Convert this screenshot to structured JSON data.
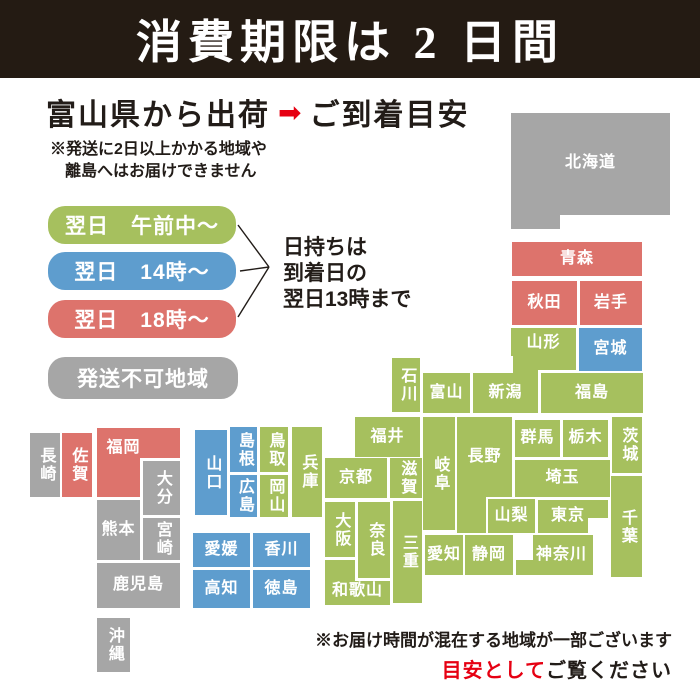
{
  "header": {
    "title": "消費期限は 2 日間"
  },
  "shipping": {
    "from_label": "富山県から出荷",
    "arrow": "➡",
    "to_label": "ご到着目安",
    "note_line1": "※発送に2日以上かかる地域や",
    "note_line2": "離島へはお届けできません"
  },
  "legend": {
    "items": [
      {
        "key": "morning",
        "label": "翌日　午前中～",
        "color": "#a6c05e"
      },
      {
        "key": "t14",
        "label": "翌日　14時～",
        "color": "#5e9dce"
      },
      {
        "key": "t18",
        "label": "翌日　18時～",
        "color": "#dd736c"
      },
      {
        "key": "noship",
        "label": "発送不可地域",
        "color": "#a6a6a6"
      }
    ],
    "keep_note_line1": "日持ちは",
    "keep_note_line2": "到着日の",
    "keep_note_line3": "翌日13時まで"
  },
  "footer": {
    "line1": "※お届け時間が混在する地域が一部ございます",
    "line2_red": "目安として",
    "line2_black": "ご覧ください"
  },
  "colors": {
    "green": "#a6c05e",
    "blue": "#5e9dce",
    "red": "#dd736c",
    "gray": "#a6a6a6",
    "accent": "#e60012",
    "header_bg": "#241b13"
  },
  "map": {
    "prefectures": [
      {
        "name": "北海道",
        "cat": "gray",
        "x": 511,
        "y": 113,
        "w": 159,
        "h": 116,
        "clip": "0,0 159,0 159,102 49,102 49,116 0,116",
        "pb": 16
      },
      {
        "name": "青森",
        "cat": "red",
        "x": 512,
        "y": 242,
        "w": 130,
        "h": 34
      },
      {
        "name": "秋田",
        "cat": "red",
        "x": 512,
        "y": 281,
        "w": 65,
        "h": 44
      },
      {
        "name": "岩手",
        "cat": "red",
        "x": 580,
        "y": 281,
        "w": 62,
        "h": 44
      },
      {
        "name": "山形",
        "cat": "green",
        "x": 511,
        "y": 328,
        "w": 65,
        "h": 42,
        "clip": "0,0 65,0 65,42 27,42 27,28 0,28",
        "pb": 12
      },
      {
        "name": "宮城",
        "cat": "blue",
        "x": 579,
        "y": 328,
        "w": 63,
        "h": 43
      },
      {
        "name": "新潟",
        "cat": "green",
        "x": 473,
        "y": 356,
        "w": 65,
        "h": 57,
        "clip": "0,17 40,17 40,0 65,0 65,57 0,57",
        "pt": 17
      },
      {
        "name": "福島",
        "cat": "green",
        "x": 541,
        "y": 373,
        "w": 102,
        "h": 40
      },
      {
        "name": "石川",
        "cat": "green",
        "x": 392,
        "y": 358,
        "w": 28,
        "h": 54,
        "v": 1
      },
      {
        "name": "富山",
        "cat": "green",
        "x": 423,
        "y": 373,
        "w": 47,
        "h": 40
      },
      {
        "name": "福井",
        "cat": "green",
        "x": 355,
        "y": 417,
        "w": 65,
        "h": 40
      },
      {
        "name": "岐阜",
        "cat": "green",
        "x": 423,
        "y": 417,
        "w": 32,
        "h": 113,
        "v": 1
      },
      {
        "name": "長野",
        "cat": "green",
        "x": 457,
        "y": 417,
        "w": 55,
        "h": 116,
        "clip": "0,0 55,0 55,80 29,80 29,116 0,116",
        "pb": 36
      },
      {
        "name": "群馬",
        "cat": "green",
        "x": 515,
        "y": 420,
        "w": 45,
        "h": 37
      },
      {
        "name": "栃木",
        "cat": "green",
        "x": 563,
        "y": 420,
        "w": 45,
        "h": 37
      },
      {
        "name": "茨城",
        "cat": "green",
        "x": 612,
        "y": 417,
        "w": 30,
        "h": 56,
        "v": 1
      },
      {
        "name": "埼玉",
        "cat": "green",
        "x": 515,
        "y": 460,
        "w": 95,
        "h": 37
      },
      {
        "name": "山梨",
        "cat": "green",
        "x": 488,
        "y": 499,
        "w": 47,
        "h": 34
      },
      {
        "name": "東京",
        "cat": "green",
        "x": 538,
        "y": 500,
        "w": 70,
        "h": 33,
        "clip": "0,0 70,0 70,18 50,18 50,33 0,33",
        "pr": 10
      },
      {
        "name": "千葉",
        "cat": "green",
        "x": 611,
        "y": 476,
        "w": 31,
        "h": 101,
        "v": 1
      },
      {
        "name": "神奈川",
        "cat": "green",
        "x": 516,
        "y": 535,
        "w": 77,
        "h": 40,
        "clip": "17,0 77,0 77,40 0,40 0,25 17,25",
        "pl": 14
      },
      {
        "name": "京都",
        "cat": "green",
        "x": 325,
        "y": 458,
        "w": 62,
        "h": 40
      },
      {
        "name": "滋賀",
        "cat": "green",
        "x": 390,
        "y": 458,
        "w": 32,
        "h": 40,
        "v": 1
      },
      {
        "name": "大阪",
        "cat": "green",
        "x": 325,
        "y": 502,
        "w": 30,
        "h": 55,
        "v": 1
      },
      {
        "name": "奈良",
        "cat": "green",
        "x": 358,
        "y": 502,
        "w": 32,
        "h": 76,
        "v": 1
      },
      {
        "name": "三重",
        "cat": "green",
        "x": 393,
        "y": 501,
        "w": 29,
        "h": 102,
        "v": 1
      },
      {
        "name": "和歌山",
        "cat": "green",
        "x": 325,
        "y": 560,
        "w": 65,
        "h": 45,
        "clip": "0,0 30,0 30,21 65,21 65,45 0,45",
        "pt": 18
      },
      {
        "name": "兵庫",
        "cat": "green",
        "x": 292,
        "y": 427,
        "w": 30,
        "h": 90,
        "v": 1
      },
      {
        "name": "鳥取",
        "cat": "green",
        "x": 260,
        "y": 427,
        "w": 28,
        "h": 45,
        "v": 1
      },
      {
        "name": "岡山",
        "cat": "green",
        "x": 260,
        "y": 475,
        "w": 28,
        "h": 42,
        "v": 1
      },
      {
        "name": "島根",
        "cat": "blue",
        "x": 230,
        "y": 427,
        "w": 27,
        "h": 45,
        "v": 1
      },
      {
        "name": "広島",
        "cat": "blue",
        "x": 230,
        "y": 475,
        "w": 27,
        "h": 42,
        "v": 1
      },
      {
        "name": "山口",
        "cat": "blue",
        "x": 195,
        "y": 430,
        "w": 32,
        "h": 85,
        "v": 1
      },
      {
        "name": "愛知",
        "cat": "green",
        "x": 425,
        "y": 535,
        "w": 38,
        "h": 40
      },
      {
        "name": "静岡",
        "cat": "green",
        "x": 465,
        "y": 535,
        "w": 48,
        "h": 40
      },
      {
        "name": "愛媛",
        "cat": "blue",
        "x": 193,
        "y": 533,
        "w": 57,
        "h": 34
      },
      {
        "name": "香川",
        "cat": "blue",
        "x": 253,
        "y": 533,
        "w": 57,
        "h": 34
      },
      {
        "name": "高知",
        "cat": "blue",
        "x": 193,
        "y": 570,
        "w": 57,
        "h": 38
      },
      {
        "name": "徳島",
        "cat": "blue",
        "x": 253,
        "y": 570,
        "w": 57,
        "h": 38
      },
      {
        "name": "福岡",
        "cat": "red",
        "x": 97,
        "y": 428,
        "w": 83,
        "h": 69,
        "clip": "0,0 83,0 83,30 43,30 43,69 0,69",
        "pb": 28,
        "pr": 30
      },
      {
        "name": "佐賀",
        "cat": "red",
        "x": 62,
        "y": 433,
        "w": 30,
        "h": 64,
        "v": 1
      },
      {
        "name": "長崎",
        "cat": "gray",
        "x": 30,
        "y": 433,
        "w": 30,
        "h": 64,
        "v": 1
      },
      {
        "name": "大分",
        "cat": "gray",
        "x": 143,
        "y": 461,
        "w": 37,
        "h": 54,
        "v": 1
      },
      {
        "name": "熊本",
        "cat": "gray",
        "x": 97,
        "y": 500,
        "w": 43,
        "h": 60
      },
      {
        "name": "宮崎",
        "cat": "gray",
        "x": 143,
        "y": 518,
        "w": 37,
        "h": 42,
        "v": 1
      },
      {
        "name": "鹿児島",
        "cat": "gray",
        "x": 97,
        "y": 563,
        "w": 83,
        "h": 45
      },
      {
        "name": "沖縄",
        "cat": "gray",
        "x": 97,
        "y": 618,
        "w": 33,
        "h": 54,
        "v": 1
      }
    ]
  }
}
